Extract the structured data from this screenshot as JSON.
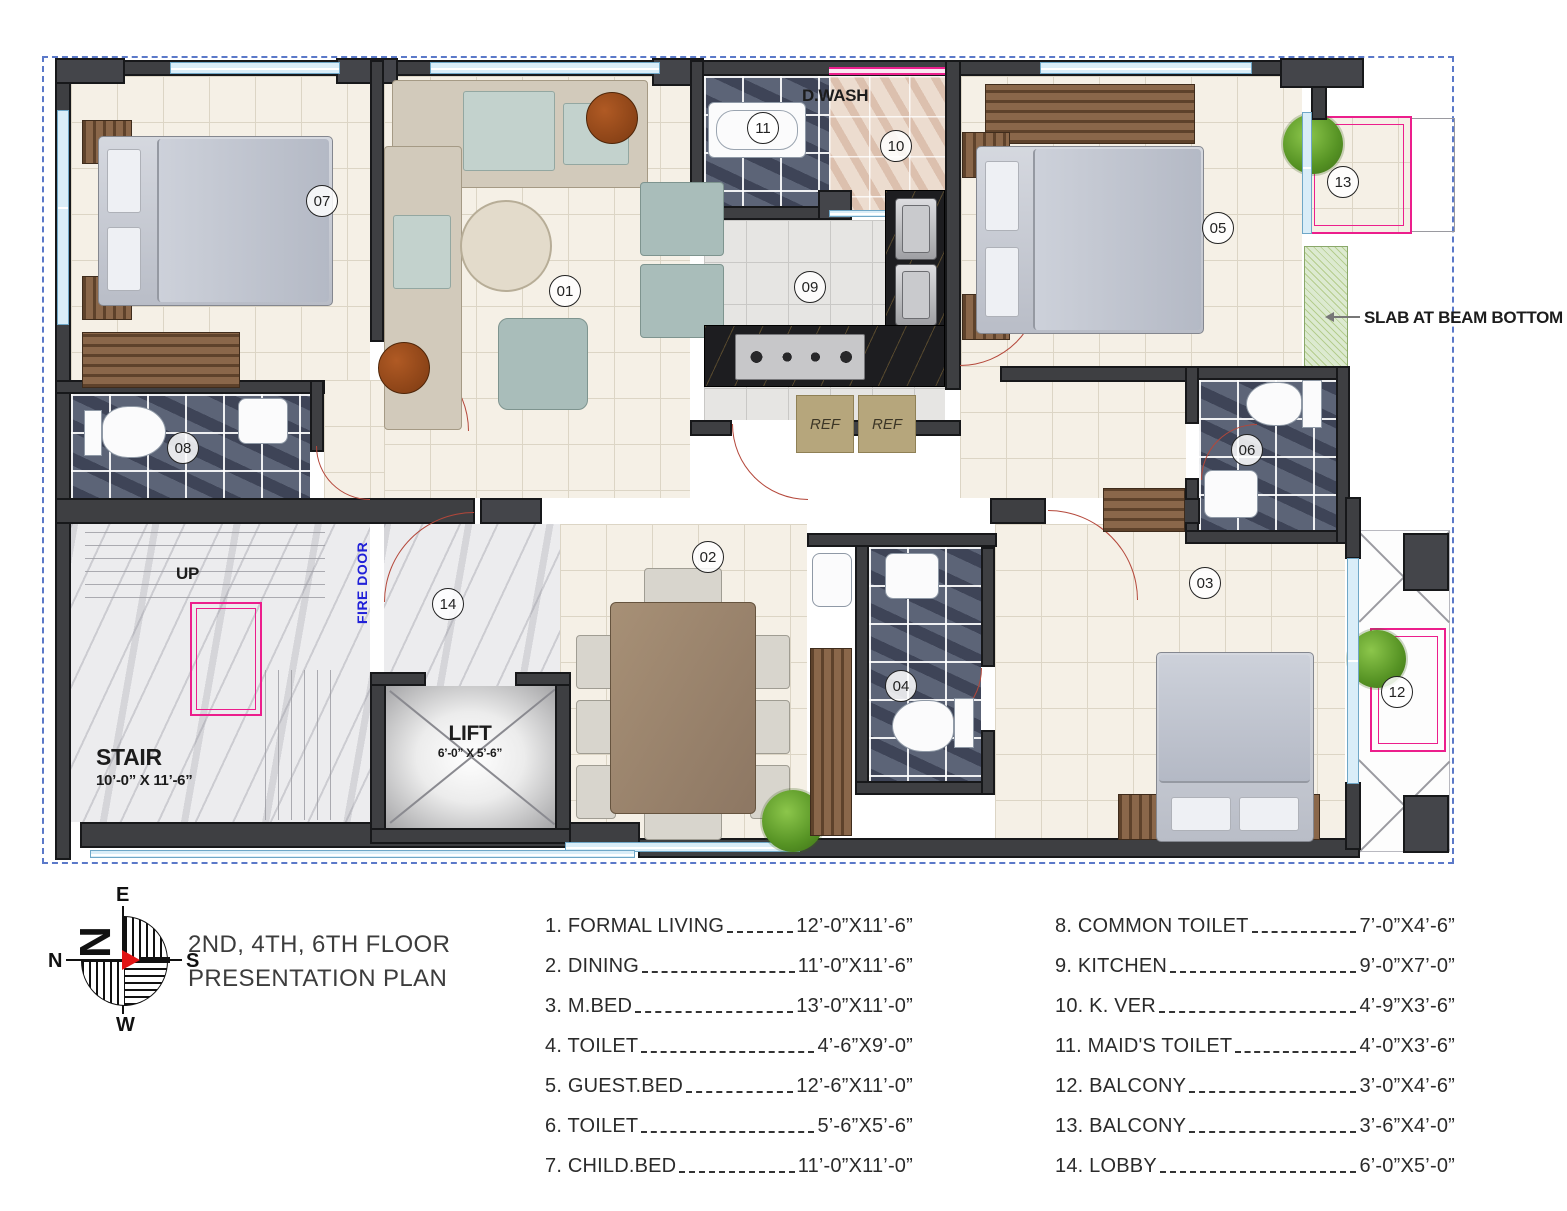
{
  "title": {
    "line1": "2ND, 4TH, 6TH FLOOR",
    "line2": "PRESENTATION PLAN"
  },
  "compass": {
    "n": "N",
    "e": "E",
    "s": "S",
    "w": "W",
    "needle_letter": "N"
  },
  "plan": {
    "markers": [
      {
        "id": "01"
      },
      {
        "id": "02"
      },
      {
        "id": "03"
      },
      {
        "id": "04"
      },
      {
        "id": "05"
      },
      {
        "id": "06"
      },
      {
        "id": "07"
      },
      {
        "id": "08"
      },
      {
        "id": "09"
      },
      {
        "id": "10"
      },
      {
        "id": "11"
      },
      {
        "id": "12"
      },
      {
        "id": "13"
      },
      {
        "id": "14"
      }
    ],
    "labels": {
      "d_wash": "D.WASH",
      "slab": "SLAB AT BEAM BOTTOM",
      "stair": "STAIR",
      "stair_dim": "10’-0” X 11’-6”",
      "up": "UP",
      "fire_door": "FIRE DOOR",
      "lift": "LIFT",
      "lift_dim": "6’-0” X 5’-6”",
      "ref_left": "REF",
      "ref_right": "REF"
    }
  },
  "legend": {
    "left": [
      {
        "label": "1. FORMAL LIVING",
        "dim": "12’-0”X11’-6”"
      },
      {
        "label": "2. DINING",
        "dim": "11’-0”X11’-6”"
      },
      {
        "label": "3. M.BED",
        "dim": "13’-0”X11’-0”"
      },
      {
        "label": "4. TOILET",
        "dim": "4’-6”X9’-0”"
      },
      {
        "label": "5. GUEST.BED",
        "dim": "12’-6”X11’-0”"
      },
      {
        "label": "6. TOILET",
        "dim": "5’-6”X5’-6”"
      },
      {
        "label": "7. CHILD.BED",
        "dim": "11’-0”X11’-0”"
      }
    ],
    "right": [
      {
        "label": "8. COMMON TOILET",
        "dim": "7’-0”X4’-6”"
      },
      {
        "label": "9. KITCHEN",
        "dim": "9’-0”X7’-0”"
      },
      {
        "label": "10. K. VER",
        "dim": "4’-9”X3’-6”"
      },
      {
        "label": "11. MAID'S TOILET",
        "dim": "4’-0”X3’-6”"
      },
      {
        "label": "12. BALCONY",
        "dim": "3’-0”X4’-6”"
      },
      {
        "label": "13. BALCONY",
        "dim": "3’-6”X4’-0”"
      },
      {
        "label": "14. LOBBY",
        "dim": "6’-0”X5’-0”"
      }
    ]
  },
  "colors": {
    "wall": "#3e3f42",
    "property_line": "#5b79c9",
    "balcony_outline": "#ec1e8c",
    "fire_door_text": "#2020d8",
    "door_swing": "#b4473a",
    "slab_hatch": "#b5cd8e",
    "compass_needle": "#e11414",
    "dark_tile": "#5c6477",
    "floor_tile": "#f5f0e6"
  }
}
